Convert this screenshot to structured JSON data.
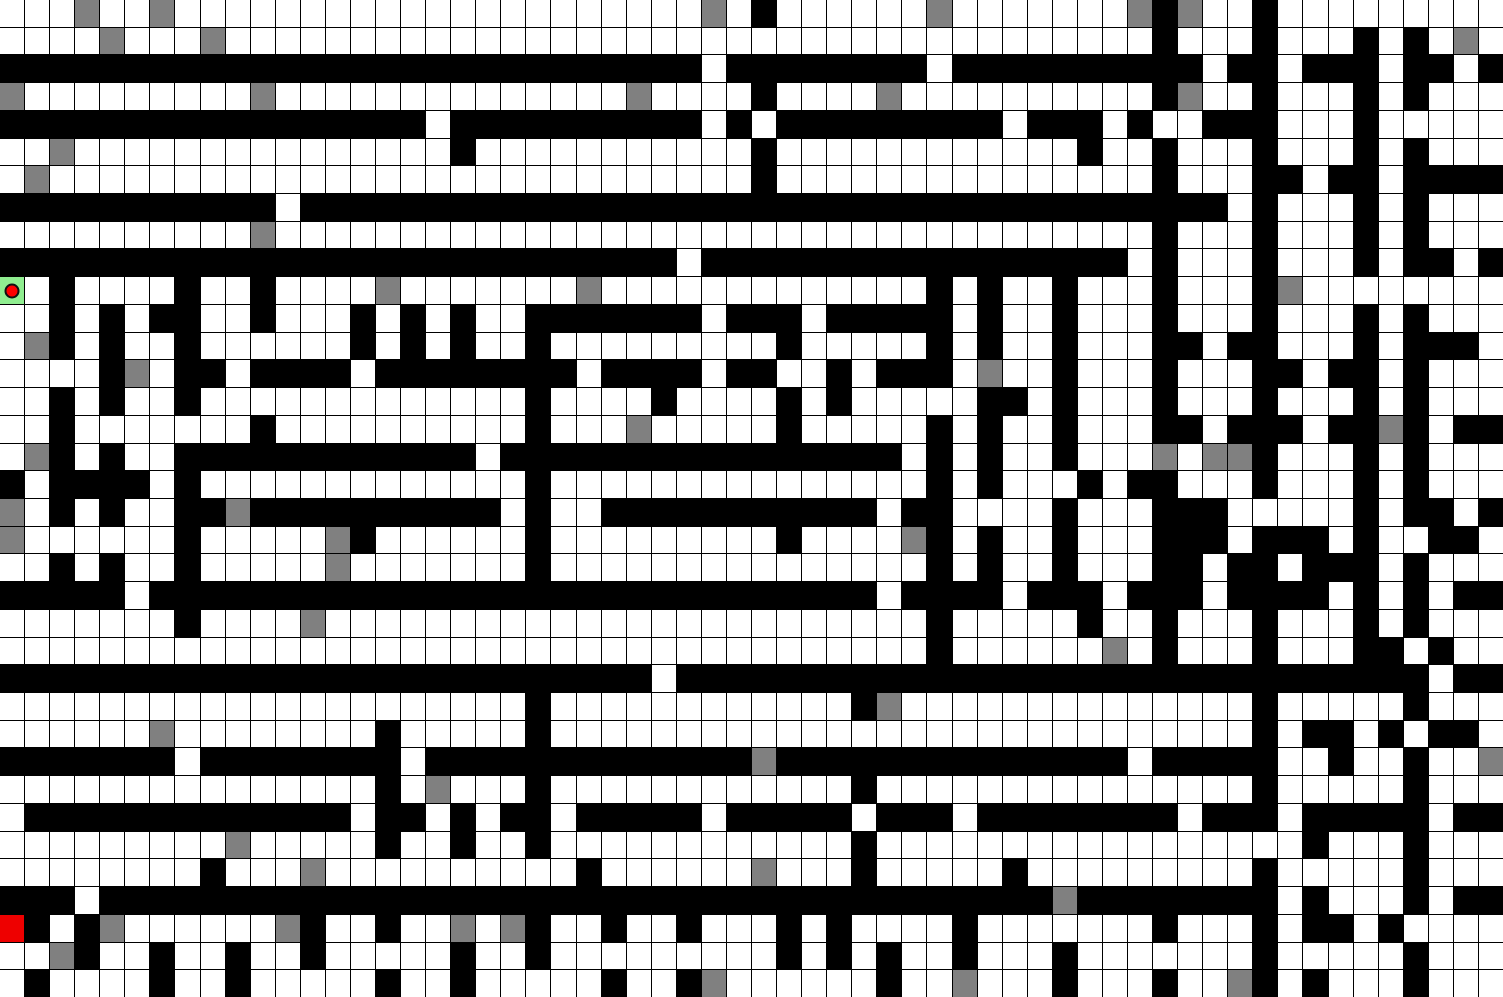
{
  "game": {
    "type": "grid-maze",
    "viewport": {
      "width_px": 1503,
      "height_px": 997
    }
  },
  "grid": {
    "cols": 60,
    "rows": 36,
    "cell_width_px": 25.05,
    "cell_height_px": 27.7,
    "legend": {
      ".": "floor",
      "#": "wall",
      "g": "gray-block",
      "S": "start",
      "R": "goal"
    },
    "rows_data": [
      "...g..g.....................g.#......g.......g#g..#.........",
      "....g...g.............................................#...#...#.#.g.",
      "############################.########.########.###.##.###.##.#",
      "g.........g..............g....#....g.........#g..#...#.#...",
      "###################.##########.#.#########.###.#..###...#.....",
      "..g...............#...........#............#..#...#...#.#...",
      ".g............................#...............#...##.##.####",
      "###########.##################################.#...#.#...",
      "..........g..................................#...#...#.#...",
      "###########################.#################.#...#...#.##.#",
      "S.#....#..#....g.......g..............#.#..#...#...#g........",
      "..#.#.##..#...#.#.#..#######.###.#####.#..#...#...#...#.#...",
      ".g#.#..#......#.#.#..#........#.....#.#..#...##.##...#.###.",
      "....#g.##.####.########.####.##..#.###.g..#...#...##.##.#...",
      "..#.#..#.............#....#....#.#.....##.#...#...#...#.#...",
      "..#.......#..........#...g.....#.....#.#..#...##.###.##g#.##",
      ".g#.#..#############.############################.#.#..#...g.gg#...#.#...",
      "#.####.#.............#...............#.#...#.##...#...#.#...",
      "g.#.#..##g###########.#..###########.##....#...###.....#.##.#",
      "g......#.....g#......#.........#....g#.#..#...###.###.#..##.",
      "..#.#..#.....g.......#................#.#..#...##.##.###.#...",
      "#####.#################################.####.###.###.####.#.#.##",
      ".......#....g.................#.....#..#...#...#.#...",
      ".............................#......g.#...#...##.#..",
      "##########################.######################.##",
      "..........#...........#g...............#.....#...",
      "......g........#.....#.................#.##.#.##.",
      "#######.########.#############g##############.#####..#..#..g",
      "...............#.g...#...........#...............#.....#...",
      ".#############.##.#.##.#####.#####.###.######.##.###.#####.##",
      ".........g.....#..#..#.............#.................#...#...",
      "........#...g..........#......g...#.....#.........#.....#...",
      "###.####################################g######.#...#.##",
      "R#.#g......g#..#..g.g#..#..#...#.#....#.......#...#.##.#....",
      "..g#..#..#..#.....#..#.........#.#.#..#...#.......#.....#...",
      ".#....#..#.....#..#.....#..#g......#..g...#...#..g#.#...#..."
    ],
    "rows_data_fixed": [
      "...g..g.....................g.#......g.......g#g..#.........",
      "....g...g.....................................#...#...#.#.g.",
      "############################.##########.########.###.##.###.##.#",
      "g.........g..............g....#....g.........#g..#...#.#...",
      "#################.##########.#.#########.###.#..###...#.....",
      "..g...............#...........#............#..#...#...#.#...",
      ".g............................#...............#...##.##.####"
    ],
    "note": "authoritative grid is in maze_rows below; one string per row, 60 chars"
  },
  "maze_rows": [
    "...g..g.....................g.#......g.......g#g..#.........",
    "....g...g.....................................#...#...#.#.g.",
    "############################.##############.#########.##.###.##.#",
    "g.........g..............g....#....g.........#g..#...#.#...",
    "#################.##########.#.#########.###.#..###...#.....",
    "..g...............#...........#............#..#...#...#.#...",
    ".g............................#...............#...##.##.####",
    "###########.###################################.#...#.#...",
    "..........g..................................#...#...#.#...",
    "############################.###################.#...#...#.##.#",
    "S.#....#..#....g.......g..............#.#..#...#...#g........",
    "..#.#.##..#...#.#.#..#######.###.#####.#..#...#...#...#.#...",
    ".g#.#..#......#.#.#..#.........#.....#.#..#...##.##...#.###.",
    "....#g.##.####.########.####.##..#.###.g..#...#...##.##.#...",
    "..#.#..#.............#....#....#.#.....##.#...#...#...#.#...",
    "..#.......#..........#...g.....#.....#.#..#...##.###.##g#.##",
    ".g#.#..########.####.###############.#.#..#...g.gg#...#.#...",
    "#.####.#..............#.................#.#...#.##...#...#.#...",
    "g.#.#..##g######.####.#..###########.##....#...###.....#.##.#",
    "g......#.....g#......#.........#....g#.#..#...###.###.#..##.",
    "..#.#..#.....g.......#................#.#..#...##.##.###.#...",
    "#####.###################################.####.###.###.####.#.#.##",
    ".......#....g.................#.....#..#...#...#.#...",
    ".............................#......g.#...#...##.#..",
    "##########################.######################.##",
    "..........#...........#g...............#.....#...",
    "......g........#.....#.................#.##.#.##.",
    "#######.########.#############g##############.#####..#..#..g"
  ],
  "maze": {
    "rows": [
      "...g..g.....................g.#......g.......g#g..#.........",
      "....g...g.....................................#...#...#.#.g.",
      "#############################.##########.########.###.##.###.##.#",
      "g.........g..............g....#....g.........#g..#...#.#...",
      "#################.##########.#.#########.###.#..###...#....."
    ]
  },
  "grid_rows": [
    "...g..g........|.............g.|#......g.......|g#g..#.........",
    "....g...g......|...............|...............|.#...#...#.#.g.",
    "###############|#############.#|#######.#######|###.##.###.##.#",
    "g.........g....|..........g....|#....g.........|.#g..#...#.#...",
    "###############|##.##########.#|.#########.###.|#..###...#.....",
    "..g............|...#...........|#............#.|.#...#...#.#...",
    ".g.............|...............|#..............|.#...##.##.####",
    "###########.###|###############|###############|####.#...#.#...",
    "..........g....|...............|...............|.#...#...#.#...",
    "###############|############.##|###############|.#...#...#.##.#",
    "S.#....#..#....|g.......g......|.......#.#..#..|.#...#g........",
    "..#.#.##..#...#|.#.#..#######.#|##.#####.#..#..|.#...#...#.#...",
    ".g#.#..#......#|.#.#..#........|.#.....#.#..#..|.##.##...#.###.",
    "....#g.##.####.|########.####.#|#..#.###.g..#..|.#...##.##.#...",
    "..#.#..#.......|......#....#...|.#.#.....##.#..|.#...#...#.#...",
    "..#.......#....|......#...g....|.#.....#.#..#..|.##.###.##g#.##",
    ".g#.#..########|####.##########|######.#.#..#..|.g.gg#...#.#...",
    "#.####.#.......|......#........|.......#.#...#.|##...#...#.#...",
    "g.#.#..##g#####|#####.#..######|#####.##....#..|.###.....#.##.#",
    "g......#.....g#|......#........|.#....g#.#..#..|.###.###.#..##.",
    "..#.#..#.....g.|......#........|.......#.#..#..|.##.##.###.#...",
    "#####.#########|###############|#####.####.###.|###.####.#.#.##",
    ".......#....g..|...............|.......#.....#.|.#...#...#.#...",
    "...............|...............|.......#......g|.#...#...##.#..",
    "###############|###########.###|###############|############.##",
    "...............|......#........|....#g.........|.....#.....#...",
    "......g........|#.....#........|...............|.....#.##.#.##.",
    "#######.#######|#.#############|g##############|.#####..#..#..g",
    "...............|#.g...#........|....#..........|.....#.....#...",
    ".#############.|##.#.##.#####.#|####.###.######|##.###.#####.##",
    ".........g.....|#..#..#........|....#..........|.......#...#...",
    "........#...g..|........#......|g...#.....#....|.....#.....#...",
    "###.###########|###############|############g##|######.#...#.##",
    "R#.#g......g#..|#..g.g#..#..#..|.#.#....#......|.#...#.##.#....",
    "..g#..#..#..#..|...#..#........|.#.#.#..#...#..|.....#.....#...",
    ".#....#..#.....|#..#.....#..#g.|.....#..g...#..|.#..g#.#...#..."
  ],
  "markers": {
    "player": {
      "row": 10,
      "col": 0,
      "shape": "red-dot-in-green-cell"
    },
    "goal": {
      "row": 33,
      "col": 0,
      "shape": "solid-red-cell"
    }
  },
  "colors": {
    "floor": "#ffffff",
    "wall": "#000000",
    "gray_block": "#808080",
    "start_cell": "#90ee90",
    "goal_cell": "#ee0000",
    "player_dot": "#ff0000",
    "grid_line": "#000000"
  }
}
